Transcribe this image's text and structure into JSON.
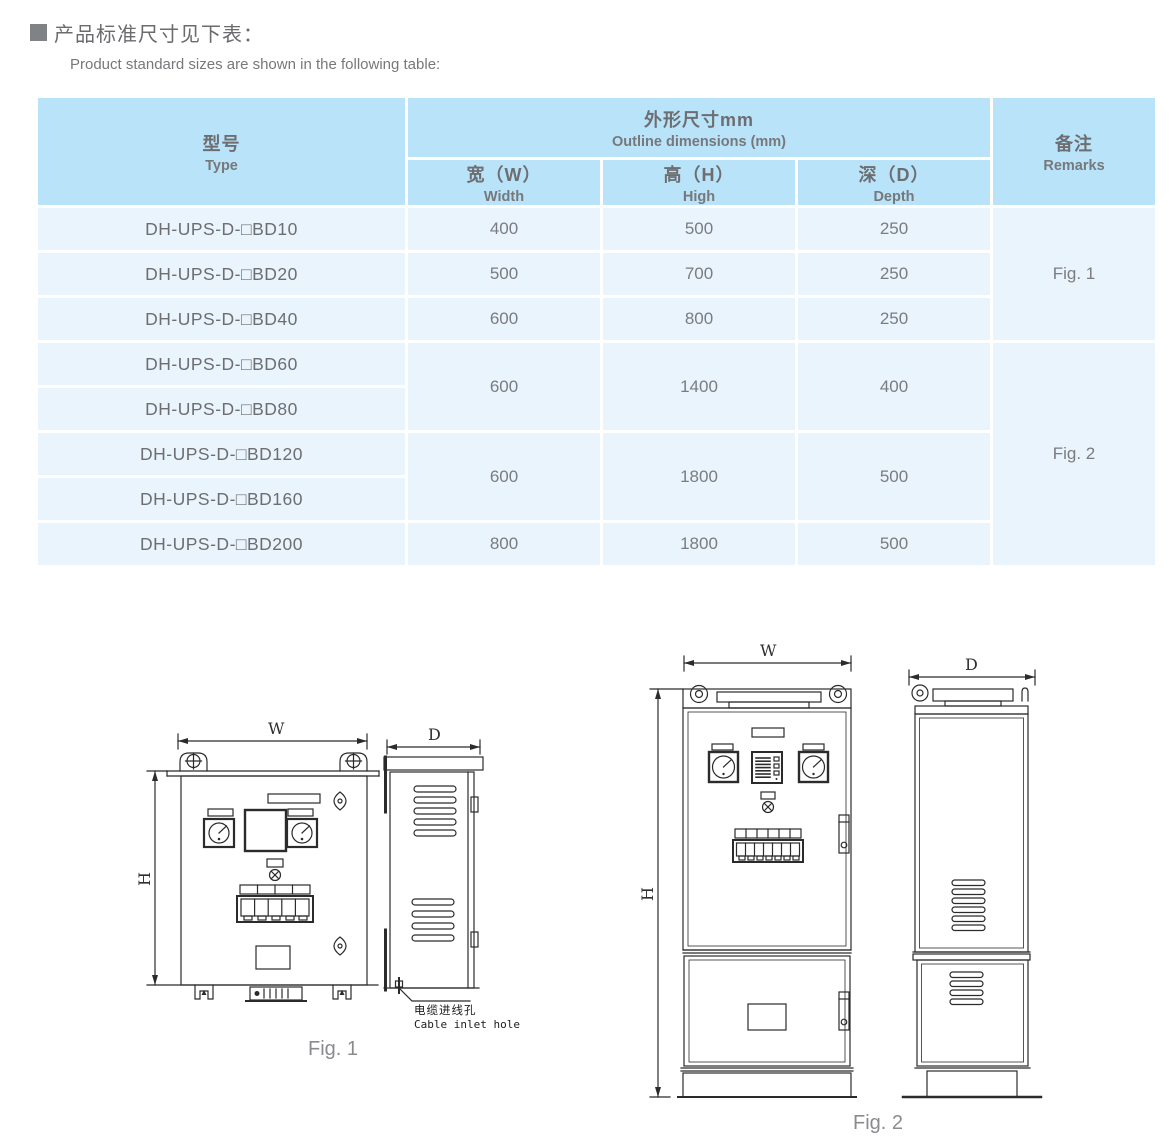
{
  "heading": {
    "zh": "产品标准尺寸见下表：",
    "en": "Product standard sizes are shown in the following table:"
  },
  "table": {
    "headers": {
      "type_zh": "型号",
      "type_en": "Type",
      "outline_zh": "外形尺寸mm",
      "outline_en": "Outline dimensions (mm)",
      "width_zh": "宽（W）",
      "width_en": "Width",
      "high_zh": "高（H）",
      "high_en": "High",
      "depth_zh": "深（D）",
      "depth_en": "Depth",
      "remarks_zh": "备注",
      "remarks_en": "Remarks"
    },
    "rows": [
      {
        "type": "DH-UPS-D-□BD10",
        "w": "400",
        "h": "500",
        "d": "250"
      },
      {
        "type": "DH-UPS-D-□BD20",
        "w": "500",
        "h": "700",
        "d": "250"
      },
      {
        "type": "DH-UPS-D-□BD40",
        "w": "600",
        "h": "800",
        "d": "250"
      },
      {
        "type": "DH-UPS-D-□BD60"
      },
      {
        "type": "DH-UPS-D-□BD80"
      },
      {
        "type": "DH-UPS-D-□BD120"
      },
      {
        "type": "DH-UPS-D-□BD160"
      },
      {
        "type": "DH-UPS-D-□BD200",
        "w": "800",
        "h": "1800",
        "d": "500"
      }
    ],
    "merged": {
      "bd60_80": {
        "w": "600",
        "h": "1400",
        "d": "400"
      },
      "bd120_160": {
        "w": "600",
        "h": "1800",
        "d": "500"
      }
    },
    "remarks": {
      "fig1": "Fig. 1",
      "fig2": "Fig. 2"
    }
  },
  "figures": {
    "fig1": {
      "caption": "Fig. 1",
      "w_label": "W",
      "h_label": "H",
      "d_label": "D",
      "cable_label_zh": "电缆进线孔",
      "cable_label_en": "Cable inlet hole"
    },
    "fig2": {
      "caption": "Fig. 2",
      "w_label": "W",
      "h_label": "H",
      "d_label": "D"
    }
  },
  "colors": {
    "header_bg": "#b9e3f8",
    "row_bg": "#e9f4fc",
    "grid_white": "#ffffff",
    "text_gray": "#7b7c80",
    "line_dark": "#2b2b2b"
  }
}
